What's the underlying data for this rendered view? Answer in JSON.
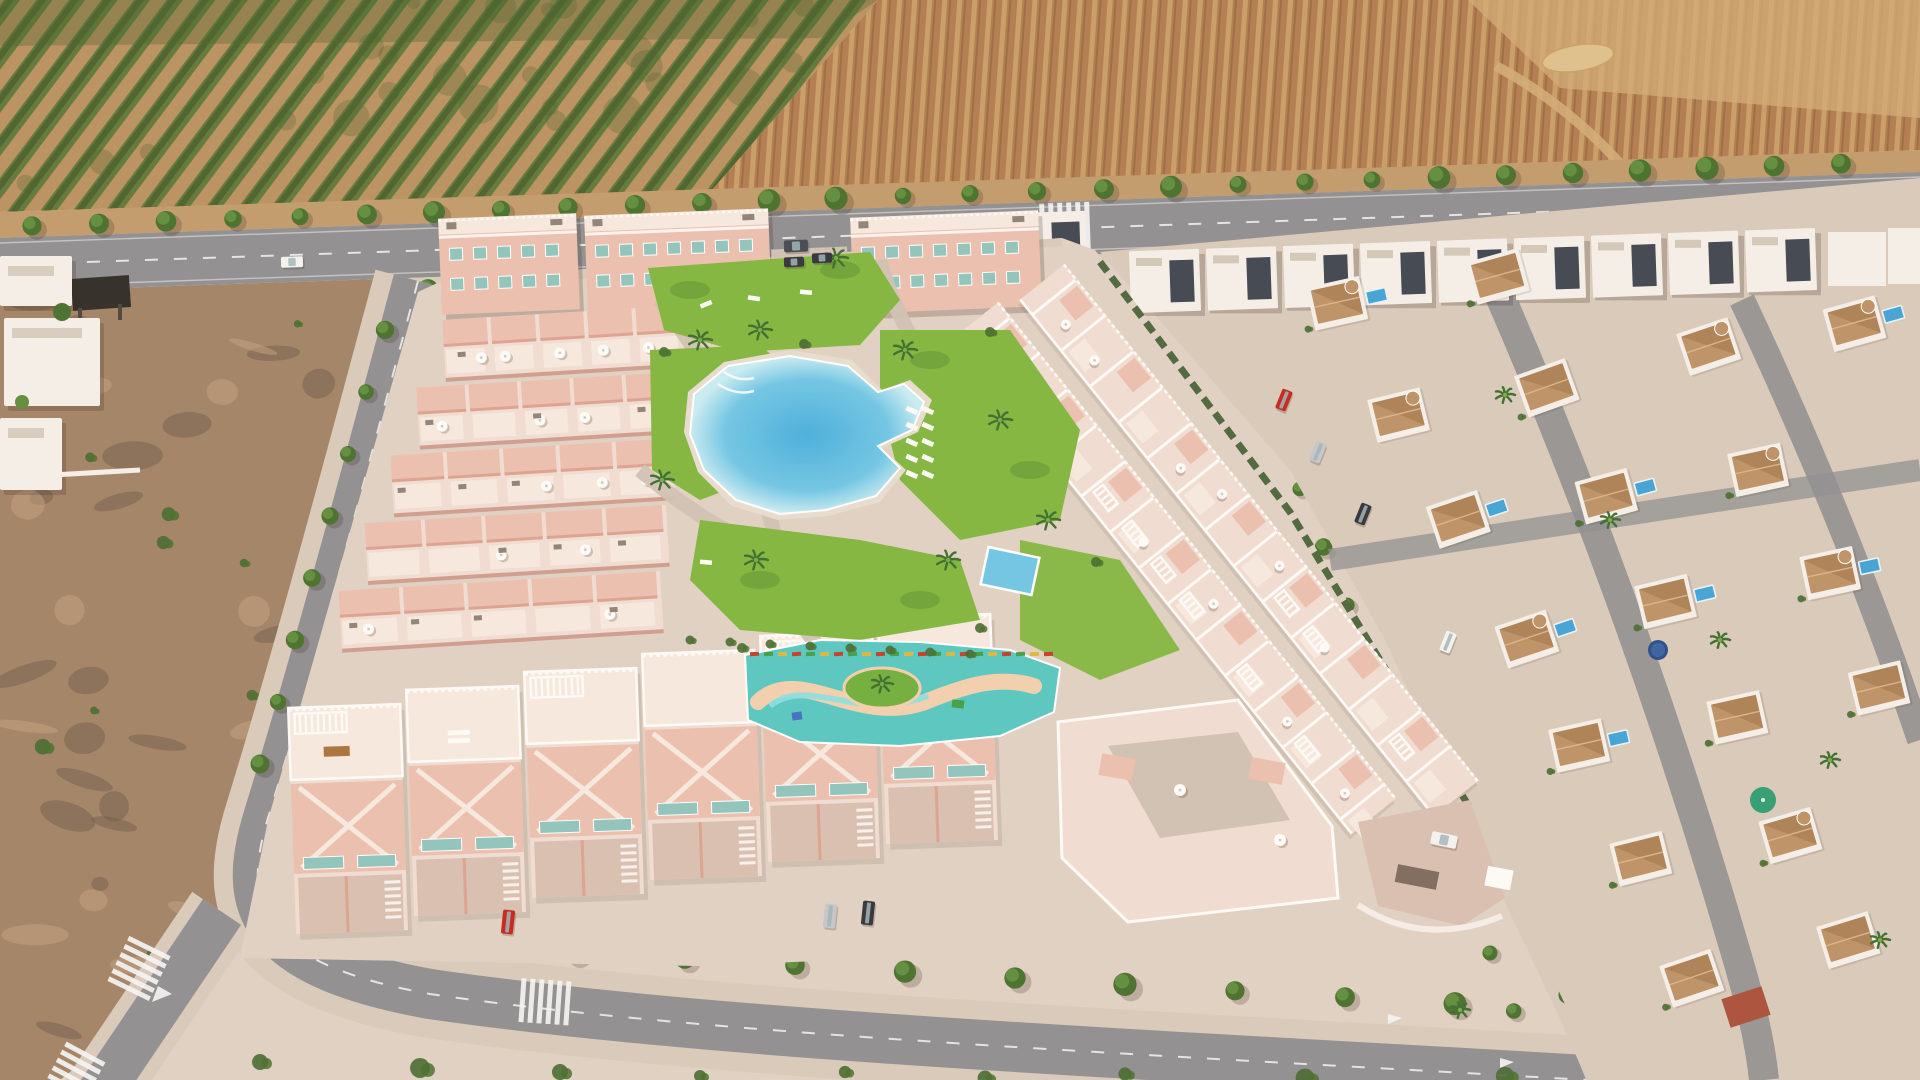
{
  "scene": {
    "description": "Sunny aerial drone render of a new-build salmon-pink residential complex with communal pools, bordered by an orchard, a ploughed farm field, scrubland and an existing villa neighbourhood",
    "time_of_day": "midday",
    "regions": [
      {
        "name": "orchard",
        "label": "orchard with diagonal tree rows"
      },
      {
        "name": "farm-field",
        "label": "brown ploughed field with furrows"
      },
      {
        "name": "main-road",
        "label": "tree-lined avenue across the top"
      },
      {
        "name": "scrubland",
        "label": "vacant scrub plot, bottom left"
      },
      {
        "name": "development",
        "label": "new salmon-pink residential complex"
      },
      {
        "name": "gardens",
        "label": "communal gardens with pools"
      },
      {
        "name": "existing-neighborhood",
        "label": "white villas with terracotta roofs and private pools"
      }
    ],
    "amenities": [
      "lagoon swimming pool",
      "children's splash pool with lazy river",
      "small rectangular pool",
      "lawned gardens",
      "palm trees",
      "sun loungers",
      "roof terraces with parasols and pergolas",
      "zebra crossings"
    ],
    "counts": {
      "apartment_blocks_top": 3,
      "townhouse_rows_left": 5,
      "townhouse_units_per_row": 5,
      "large_townhouses_bottom": 6,
      "bungalow_rows_right": 2,
      "main_road_trees_north": 28,
      "main_road_trees_south": 14,
      "white_modern_houses": 9,
      "villas": 34,
      "villa_pools": 8,
      "palm_trees_garden": 9,
      "palm_trees_neighborhood": 8,
      "sun_loungers": 10
    },
    "vehicles": [
      {
        "color": "white",
        "location": "main road"
      },
      {
        "color": "dark grey",
        "location": "main road"
      },
      {
        "color": "dark",
        "location": "apartment parking"
      },
      {
        "color": "dark",
        "location": "apartment parking"
      },
      {
        "color": "red",
        "location": "townhouse driveway"
      },
      {
        "color": "silver",
        "location": "townhouse driveway"
      },
      {
        "color": "dark",
        "location": "townhouse driveway"
      },
      {
        "color": "white",
        "location": "development entrance ramp"
      },
      {
        "color": "red",
        "location": "neighbourhood street"
      },
      {
        "color": "silver",
        "location": "neighbourhood street"
      },
      {
        "color": "dark",
        "location": "neighbourhood street"
      },
      {
        "color": "white",
        "location": "neighbourhood street"
      }
    ],
    "palette": {
      "orchard_soil": "#b9905f",
      "orchard_green": "#5e7838",
      "orchard_dark": "#49602c",
      "field_brown": "#b07c4e",
      "field_light": "#c99c66",
      "field_pale": "#d2ab76",
      "straw": "#dec08c",
      "road_asphalt": "#8e8e90",
      "road_line": "#f5f5f5",
      "verge_tan": "#c19a6b",
      "scrub": "#a18266",
      "scrub_dark": "#6e5a47",
      "scrub_green": "#6f7c4a",
      "scrub_light": "#c2a27e",
      "sidewalk": "#d8cabb",
      "dev_ground": "#e0d1c5",
      "dev_path": "#cfc1b4",
      "paver": "#d9bfb0",
      "salmon": "#eabfaf",
      "salmon_dark": "#dca290",
      "salmon_deep": "#c98e80",
      "terrace": "#f0ddd2",
      "terrace_light": "#f6e9df",
      "white": "#fdfcfa",
      "window_teal": "#8ec4be",
      "lawn": "#7fb63d",
      "lawn_dark": "#5d9432",
      "shrub": "#44682e",
      "palm": "#3c6b2d",
      "hedge": "#3b5a2c",
      "pool_light": "#c8ecf4",
      "pool_mid": "#6ec6e6",
      "pool_deep": "#46aedd",
      "kids_deck": "#56c8c1",
      "kids_sand": "#f2d0ae",
      "kids_water": "#8adfe2",
      "island_green": "#6fae3b",
      "villa_wall": "#f4f0e9",
      "villa_shadow": "#c9beae",
      "roof_terracotta": "#bd9166",
      "roof_terracotta_dark": "#9c7247",
      "roof_red": "#a94f38",
      "pool_villa": "#3fa3d8",
      "modern_dark": "#3e4450",
      "car_white": "#f4f4f2",
      "car_red": "#c32319",
      "car_silver": "#c3c7ca",
      "car_dark": "#2e3237",
      "van_dark": "#42474d",
      "tree_green": "#5d8c3b",
      "tree_dark": "#466f2c",
      "trunk": "#6b5537",
      "shadow": "rgba(55,38,28,0.22)"
    }
  }
}
